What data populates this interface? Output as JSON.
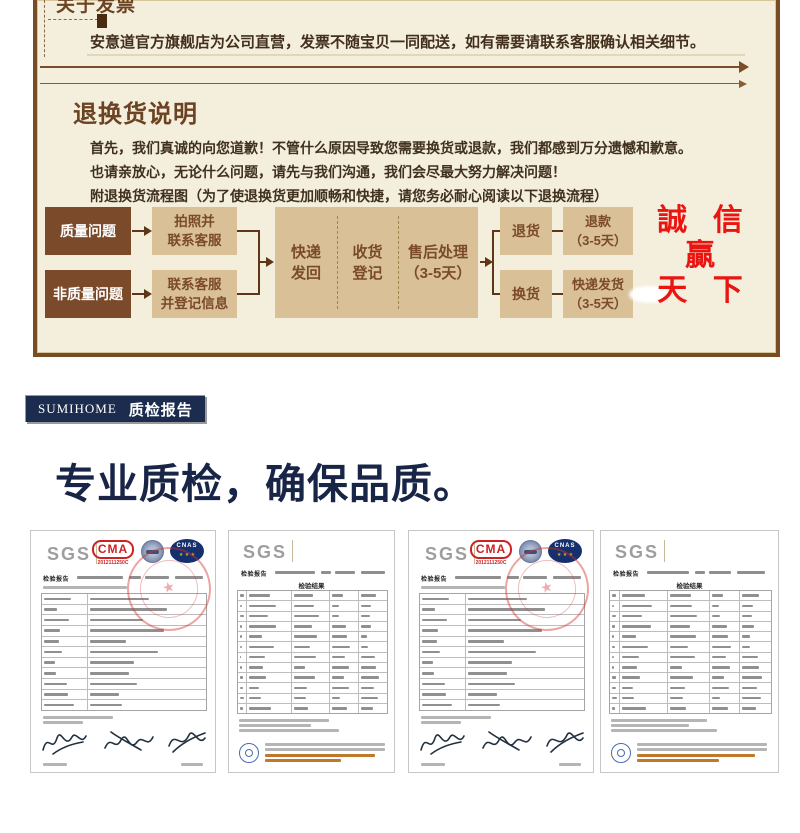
{
  "colors": {
    "cream_bg": "#f4eedd",
    "box_border_brown": "#7a4c24",
    "flow_dark_brown": "#7b4a2b",
    "flow_tan": "#d9c097",
    "slogan_red": "#ea1510",
    "badge_navy": "#1c2c4e",
    "heading_navy": "#182546"
  },
  "notice": {
    "invoice_title": "关于发票",
    "invoice_body": "安意道官方旗舰店为公司直营，发票不随宝贝一同配送，如有需要请联系客服确认相关细节。",
    "returns_title": "退换货说明",
    "returns_line1": "首先，我们真诚的向您道歉！不管什么原因导致您需要换货或退款，我们都感到万分遗憾和歉意。",
    "returns_line2": "也请亲放心，无论什么问题，请先与我们沟通，我们会尽最大努力解决问题！",
    "returns_line3": "附退换货流程图（为了使退换货更加顺畅和快捷，请您务必耐心阅读以下退换流程）"
  },
  "flow": {
    "source_quality": "质量问题",
    "source_non_quality": "非质量问题",
    "step_photo_l1": "拍照并",
    "step_photo_l2": "联系客服",
    "step_contact_l1": "联系客服",
    "step_contact_l2": "并登记信息",
    "mid_ship_l1": "快递",
    "mid_ship_l2": "发回",
    "mid_receive_l1": "收货",
    "mid_receive_l2": "登记",
    "mid_aftersale_l1": "售后处理",
    "mid_aftersale_l2": "（3-5天）",
    "out_return": "退货",
    "out_exchange": "换货",
    "result_refund_l1": "退款",
    "result_refund_l2": "（3-5天）",
    "result_reship_l1": "快递发货",
    "result_reship_l2": "（3-5天）"
  },
  "slogan": {
    "l1": "誠 信",
    "l2": "贏",
    "l3": "天 下"
  },
  "qc": {
    "badge_brand": "SUMIHOME",
    "badge_label": "质检报告",
    "heading": "专业质检，确保品质。",
    "cert_a": {
      "logo": "SGS",
      "cma": "CMA",
      "cma_no": "2012111250C",
      "cnas": "CNAS",
      "report_label": "检验报告",
      "stamp_star": "★"
    },
    "cert_b": {
      "logo": "SGS",
      "report_label": "检验报告",
      "result_title": "检验结果"
    }
  }
}
